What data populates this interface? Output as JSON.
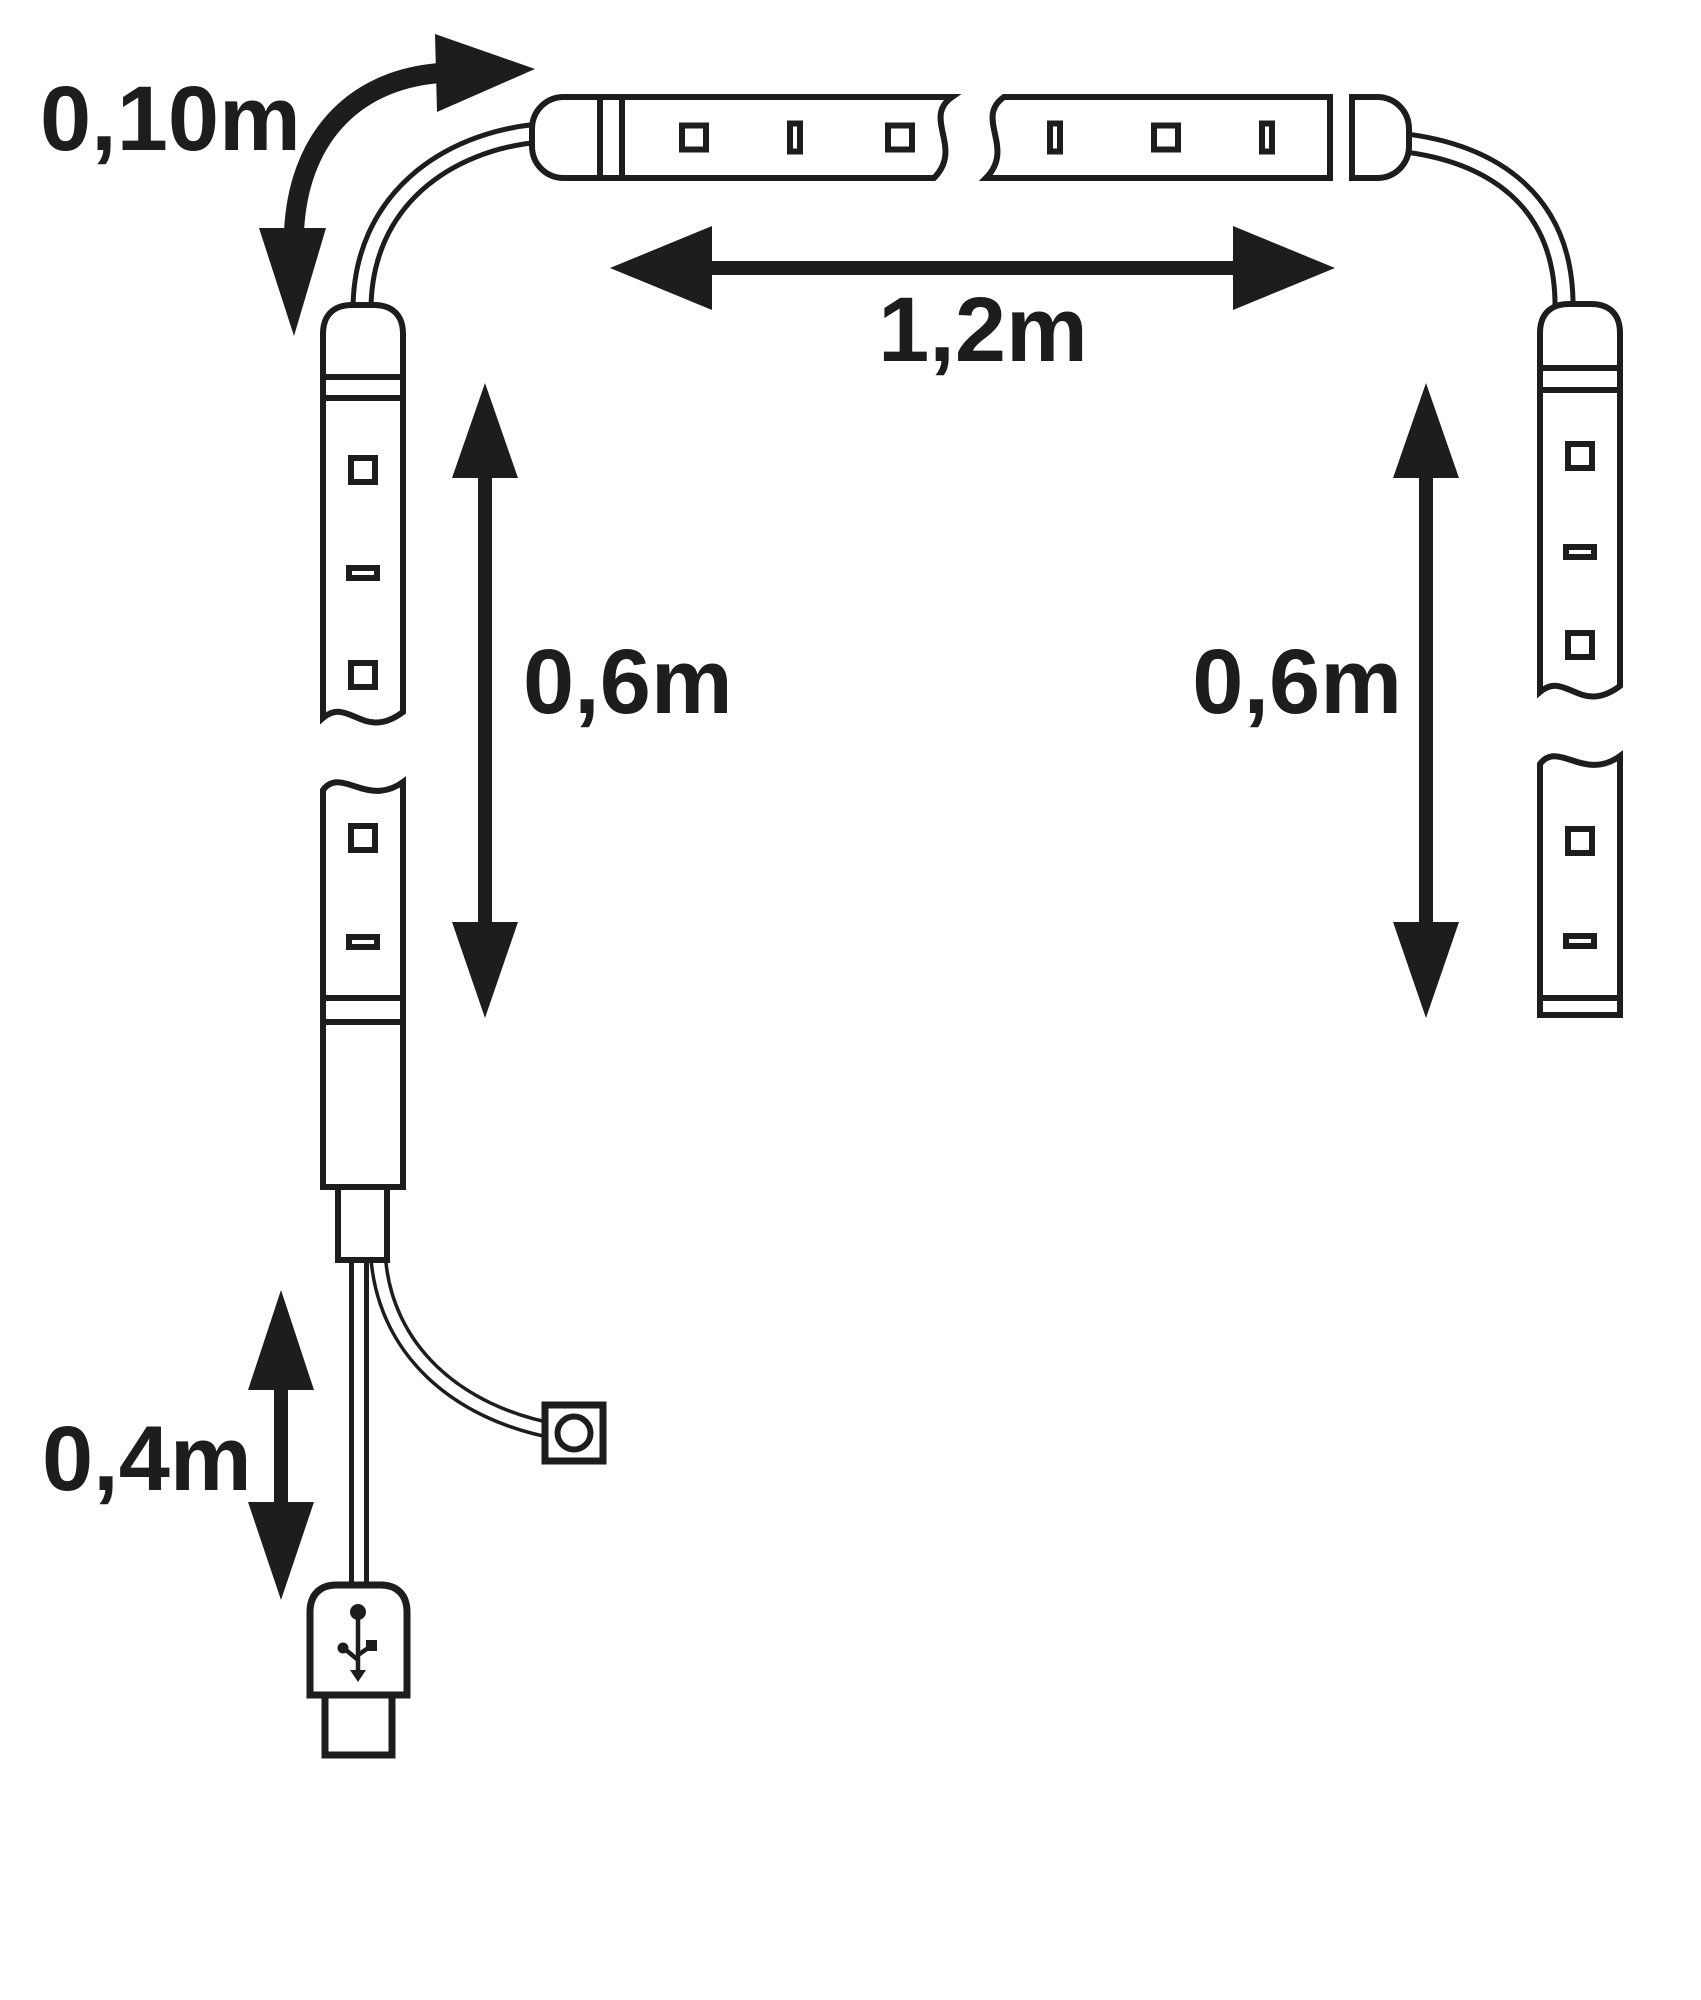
{
  "diagram": {
    "background_color": "#ffffff",
    "line_color": "#1d1d1b",
    "labels": {
      "connector_cable_length": "0,10m",
      "horizontal_strip_length": "1,2m",
      "left_strip_length": "0,6m",
      "right_strip_length": "0,6m",
      "usb_cable_length": "0,4m"
    },
    "icons": {
      "usb": "usb-trident-icon",
      "switch": "switch-circle-icon",
      "arrows": "dimension-arrow"
    }
  }
}
